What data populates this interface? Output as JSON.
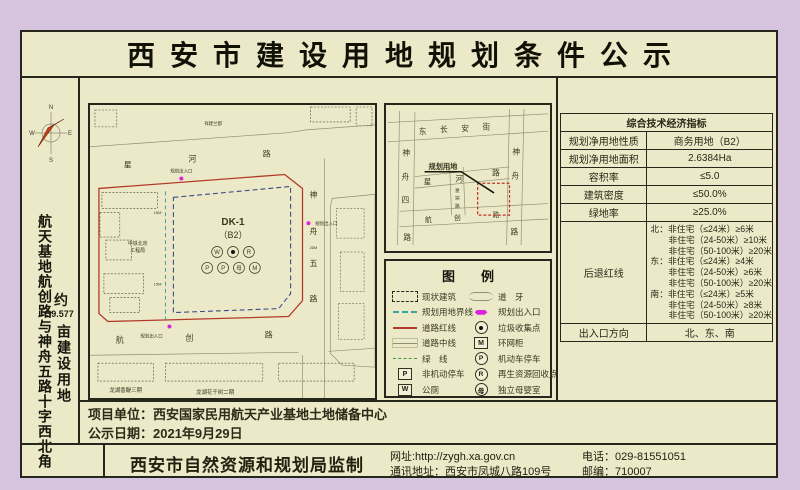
{
  "title": "西安市建设用地规划条件公示",
  "colors": {
    "background": "#d7c5e0",
    "paper": "#ece9c9",
    "red_line": "#b23b28",
    "boundary_teal": "#3aa49c",
    "plot_dash_navy": "#3a4a8c",
    "entrance_magenta": "#dd22dd",
    "green_line": "#3f9b3f"
  },
  "sidebar": {
    "compass": {
      "n": "N",
      "e": "E",
      "s": "S",
      "w": "W"
    },
    "location": "航天基地航创路与神舟五路十字西北角",
    "area_about": "约",
    "area_value": "39.577",
    "area_unit": "亩建设用地"
  },
  "site_plan": {
    "plot_code": "DK-1",
    "plot_use": "（B2）",
    "entrance": "规划出入口",
    "dim_15m": "15M",
    "dim_20m": "20M",
    "road_top": [
      "星",
      "河",
      "路"
    ],
    "road_bottom": [
      "航",
      "创",
      "路"
    ],
    "road_right": [
      "神",
      "舟",
      "五",
      "路"
    ],
    "bldg_top": "祥建兰郡",
    "bldg_left_1": "中铁北京",
    "bldg_left_2": "工程局",
    "bldg_bottom_left": "龙湖香醍三期",
    "bldg_bottom_right": "龙湖花千树二期"
  },
  "location_map": {
    "street_top": [
      "东",
      "长",
      "安",
      "街"
    ],
    "road_left": [
      "神",
      "舟",
      "四",
      "路"
    ],
    "road_right": [
      "神",
      "舟",
      "路"
    ],
    "road_mid_h": [
      "星",
      "河",
      "路"
    ],
    "road_mid_v": [
      "星",
      "宗",
      "路"
    ],
    "road_bottom": [
      "航",
      "创",
      "路"
    ],
    "callout": "规划用地"
  },
  "legend": {
    "title": "图　　例",
    "left": [
      "现状建筑",
      "规划用地界线",
      "道路红线",
      "道路中线",
      "绿　线",
      "非机动停车",
      "公厕"
    ],
    "right": [
      "道　牙",
      "规划出入口",
      "垃圾收集点",
      "环网柜",
      "机动车停车",
      "再生资源回收点",
      "独立母婴室"
    ],
    "icon_p": "P",
    "icon_w": "W",
    "icon_m": "M",
    "icon_r": "R",
    "icon_mu": "母"
  },
  "table": {
    "header": "综合技术经济指标",
    "rows": [
      {
        "label": "规划净用地性质",
        "value": "商务用地（B2）"
      },
      {
        "label": "规划净用地面积",
        "value": "2.6384Ha"
      },
      {
        "label": "容积率",
        "value": "≤5.0"
      },
      {
        "label": "建筑密度",
        "value": "≤50.0%"
      },
      {
        "label": "绿地率",
        "value": "≥25.0%"
      }
    ],
    "setback_label": "后退红线",
    "setback_lines": [
      "北：非住宅（≤24米）≥6米",
      "非住宅（24-50米）≥10米",
      "非住宅（50-100米）≥20米",
      "东：非住宅（≤24米）≥4米",
      "非住宅（24-50米）≥6米",
      "非住宅（50-100米）≥20米",
      "南：非住宅（≤24米）≥5米",
      "非住宅（24-50米）≥8米",
      "非住宅（50-100米）≥20米"
    ],
    "exit_label": "出入口方向",
    "exit_value": "北、东、南"
  },
  "project": {
    "unit": "项目单位：西安国家民用航天产业基地土地储备中心",
    "date": "公示日期：2021年9月29日"
  },
  "footer": {
    "producer": "西安市自然资源和规划局监制",
    "website": "网址:http://zygh.xa.gov.cn",
    "address": "通讯地址：西安市凤城八路109号",
    "phone": "电话：029-81551051",
    "postcode": "邮编：710007"
  }
}
